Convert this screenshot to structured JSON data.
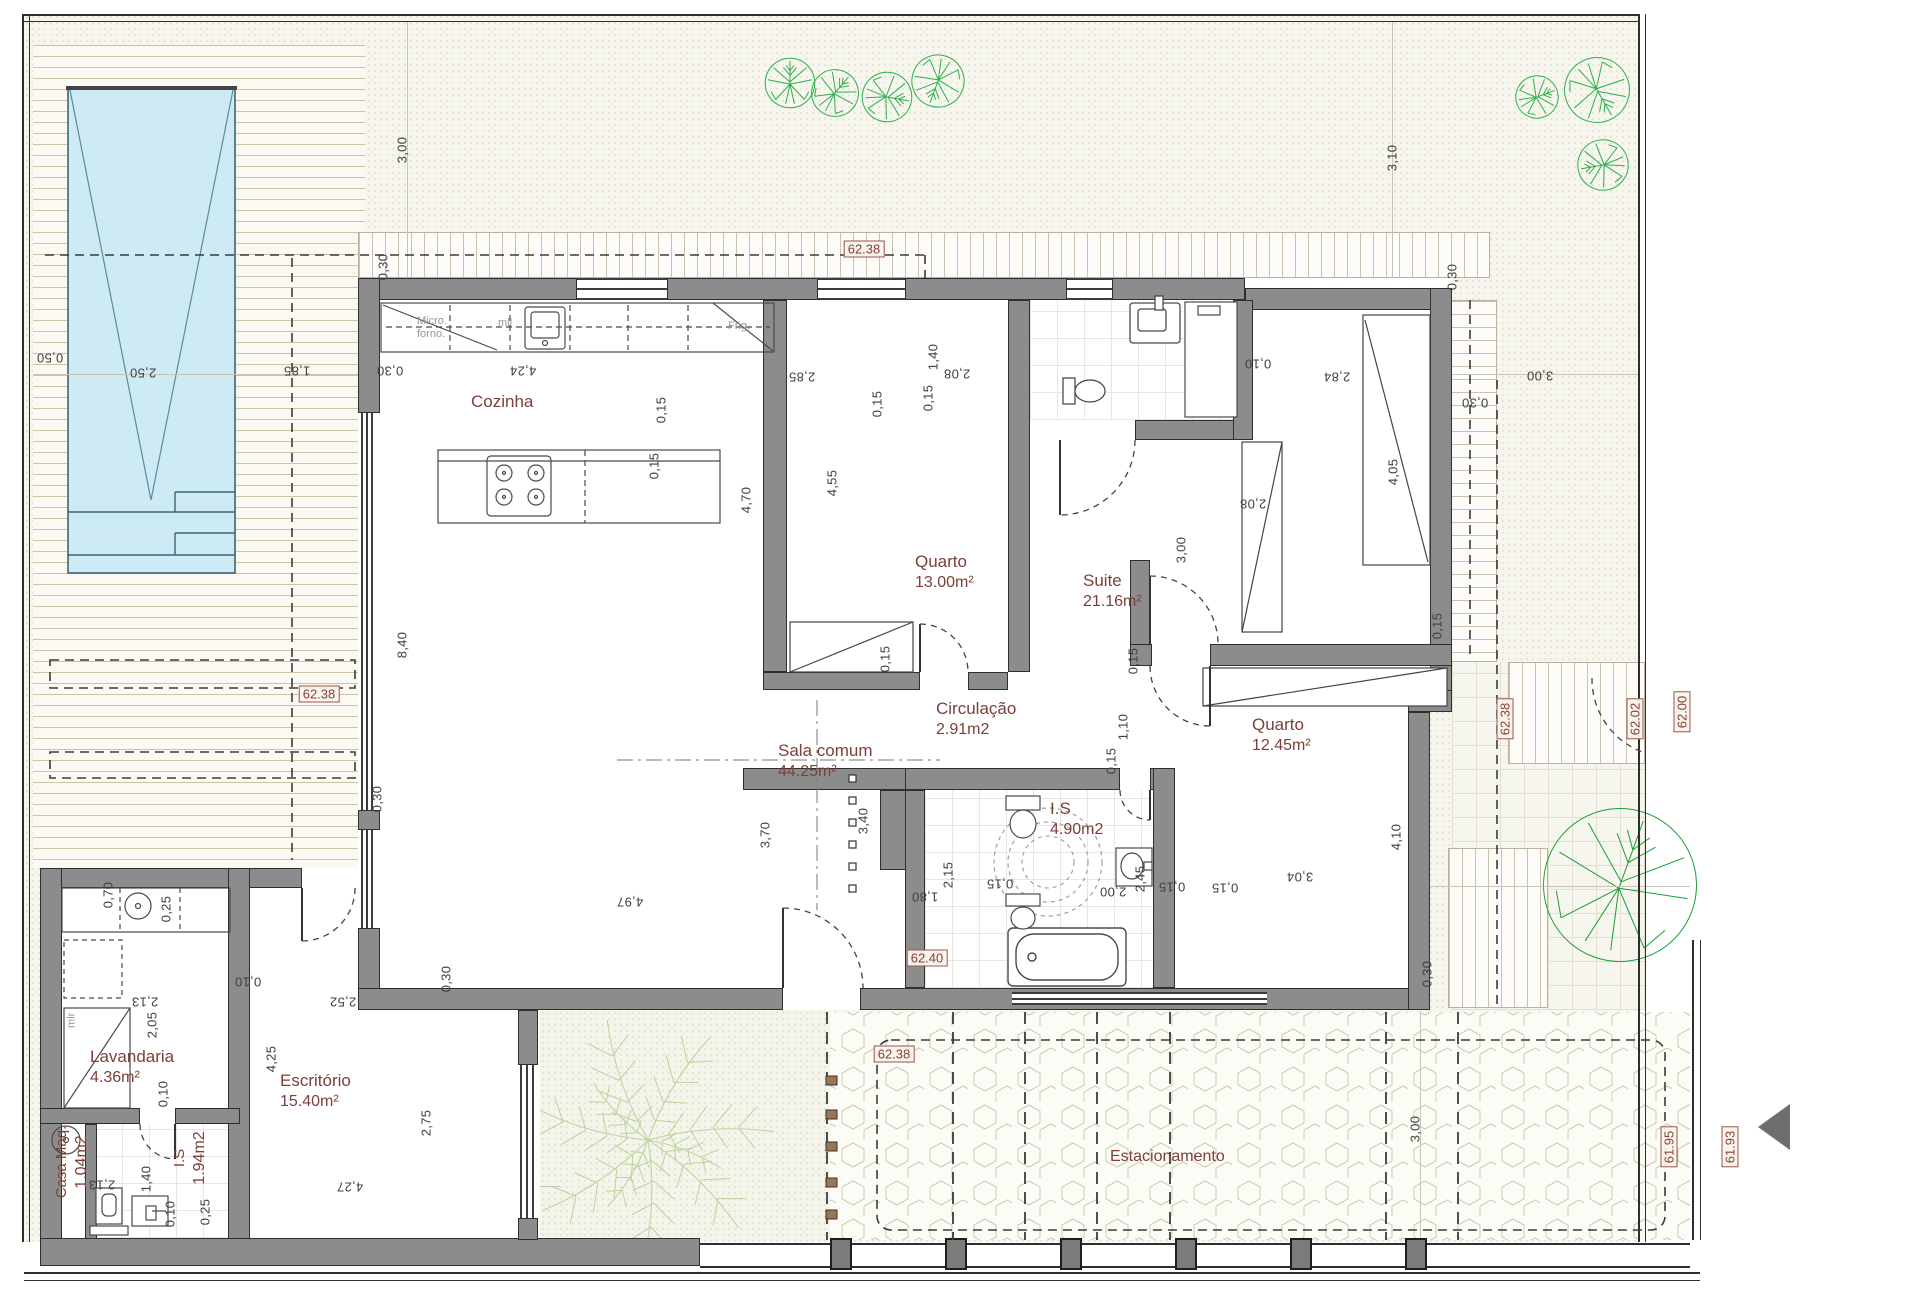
{
  "drawing_type": "architectural floor plan",
  "rooms": [
    {
      "name": "Cozinha",
      "area": ""
    },
    {
      "name": "Quarto",
      "area": "13.00m²"
    },
    {
      "name": "Suite",
      "area": "21.16m²"
    },
    {
      "name": "Circulação",
      "area": "2.91m2"
    },
    {
      "name": "Quarto",
      "area": "12.45m²"
    },
    {
      "name": "Sala comum",
      "area": "44.25m²"
    },
    {
      "name": "I.S",
      "area": "4.90m2"
    },
    {
      "name": "Lavandaria",
      "area": "4.36m²"
    },
    {
      "name": "Escritório",
      "area": "15.40m²"
    },
    {
      "name": "Casa Maq.",
      "area": "1.04m2"
    },
    {
      "name": "I.S",
      "area": "1.94m2"
    },
    {
      "name": "Estacionamento",
      "area": ""
    }
  ],
  "kitchen_labels": {
    "micro": "Micro.",
    "forno": "forno.",
    "mll": "mll",
    "frig": "Frig.",
    "mlr": "mlr"
  },
  "elevation_markers": [
    {
      "v": "62.38",
      "x": 864,
      "y": 249,
      "r": 0
    },
    {
      "v": "62.38",
      "x": 319,
      "y": 694,
      "r": 0
    },
    {
      "v": "62.40",
      "x": 927,
      "y": 958,
      "r": 0
    },
    {
      "v": "62.38",
      "x": 894,
      "y": 1054,
      "r": 0
    },
    {
      "v": "62.38",
      "x": 1505,
      "y": 719,
      "r": -90
    },
    {
      "v": "62.02",
      "x": 1635,
      "y": 719,
      "r": -90
    },
    {
      "v": "62.00",
      "x": 1682,
      "y": 712,
      "r": -90
    },
    {
      "v": "61.95",
      "x": 1669,
      "y": 1147,
      "r": -90
    },
    {
      "v": "61.93",
      "x": 1730,
      "y": 1147,
      "r": -90
    }
  ],
  "dimensions": [
    {
      "v": "3,00",
      "x": 402,
      "y": 150,
      "r": -90
    },
    {
      "v": "3,10",
      "x": 1392,
      "y": 158,
      "r": -90
    },
    {
      "v": "0,50",
      "x": 50,
      "y": 358,
      "r": 180
    },
    {
      "v": "2,50",
      "x": 143,
      "y": 373,
      "r": 180
    },
    {
      "v": "1,85",
      "x": 297,
      "y": 371,
      "r": 180
    },
    {
      "v": "0,30",
      "x": 383,
      "y": 267,
      "r": -90
    },
    {
      "v": "0,30",
      "x": 390,
      "y": 371,
      "r": 180
    },
    {
      "v": "4,24",
      "x": 523,
      "y": 371,
      "r": 180
    },
    {
      "v": "2,85",
      "x": 802,
      "y": 377,
      "r": 180
    },
    {
      "v": "0,15",
      "x": 661,
      "y": 410,
      "r": -90
    },
    {
      "v": "0,15",
      "x": 654,
      "y": 466,
      "r": -90
    },
    {
      "v": "4,70",
      "x": 746,
      "y": 500,
      "r": -90
    },
    {
      "v": "4,55",
      "x": 832,
      "y": 483,
      "r": -90
    },
    {
      "v": "1,40",
      "x": 933,
      "y": 357,
      "r": -90
    },
    {
      "v": "2,08",
      "x": 957,
      "y": 374,
      "r": 180
    },
    {
      "v": "0,15",
      "x": 928,
      "y": 398,
      "r": -90
    },
    {
      "v": "0,15",
      "x": 877,
      "y": 404,
      "r": -90
    },
    {
      "v": "0,10",
      "x": 1258,
      "y": 364,
      "r": 180
    },
    {
      "v": "2,84",
      "x": 1337,
      "y": 377,
      "r": 180
    },
    {
      "v": "3,00",
      "x": 1540,
      "y": 376,
      "r": 180
    },
    {
      "v": "0,30",
      "x": 1452,
      "y": 277,
      "r": -90
    },
    {
      "v": "0,30",
      "x": 1475,
      "y": 403,
      "r": 180
    },
    {
      "v": "4,05",
      "x": 1393,
      "y": 472,
      "r": -90
    },
    {
      "v": "2,08",
      "x": 1253,
      "y": 504,
      "r": 180
    },
    {
      "v": "3,00",
      "x": 1181,
      "y": 550,
      "r": -90
    },
    {
      "v": "0,15",
      "x": 885,
      "y": 659,
      "r": -90
    },
    {
      "v": "0,15",
      "x": 1437,
      "y": 626,
      "r": -90
    },
    {
      "v": "0,15",
      "x": 1133,
      "y": 661,
      "r": -90
    },
    {
      "v": "1,10",
      "x": 1123,
      "y": 727,
      "r": -90
    },
    {
      "v": "0,15",
      "x": 1111,
      "y": 761,
      "r": -90
    },
    {
      "v": "3,40",
      "x": 863,
      "y": 821,
      "r": -90
    },
    {
      "v": "3,70",
      "x": 765,
      "y": 835,
      "r": -90
    },
    {
      "v": "2,15",
      "x": 948,
      "y": 875,
      "r": -90
    },
    {
      "v": "1,80",
      "x": 925,
      "y": 897,
      "r": 180
    },
    {
      "v": "0,15",
      "x": 1000,
      "y": 884,
      "r": 180
    },
    {
      "v": "2,00",
      "x": 1113,
      "y": 892,
      "r": 180
    },
    {
      "v": "2,45",
      "x": 1140,
      "y": 879,
      "r": -90
    },
    {
      "v": "0,15",
      "x": 1172,
      "y": 887,
      "r": 180
    },
    {
      "v": "0,15",
      "x": 1225,
      "y": 888,
      "r": 180
    },
    {
      "v": "4,10",
      "x": 1396,
      "y": 837,
      "r": -90
    },
    {
      "v": "3,04",
      "x": 1300,
      "y": 877,
      "r": 180
    },
    {
      "v": "8,40",
      "x": 402,
      "y": 645,
      "r": -90
    },
    {
      "v": "0,70",
      "x": 108,
      "y": 895,
      "r": -90
    },
    {
      "v": "0,25",
      "x": 166,
      "y": 909,
      "r": -90
    },
    {
      "v": "2,13",
      "x": 145,
      "y": 1002,
      "r": 180
    },
    {
      "v": "2,05",
      "x": 152,
      "y": 1025,
      "r": -90
    },
    {
      "v": "0,10",
      "x": 163,
      "y": 1094,
      "r": -90
    },
    {
      "v": "0,10",
      "x": 248,
      "y": 982,
      "r": 180
    },
    {
      "v": "2,52",
      "x": 343,
      "y": 1002,
      "r": 180
    },
    {
      "v": "4,25",
      "x": 271,
      "y": 1059,
      "r": -90
    },
    {
      "v": "2,13",
      "x": 102,
      "y": 1185,
      "r": 180
    },
    {
      "v": "1,40",
      "x": 146,
      "y": 1179,
      "r": -90
    },
    {
      "v": "0,10",
      "x": 170,
      "y": 1214,
      "r": -90
    },
    {
      "v": "0,25",
      "x": 205,
      "y": 1212,
      "r": -90
    },
    {
      "v": "4,27",
      "x": 350,
      "y": 1187,
      "r": 180
    },
    {
      "v": "2,75",
      "x": 426,
      "y": 1123,
      "r": -90
    },
    {
      "v": "0,30",
      "x": 446,
      "y": 979,
      "r": -90
    },
    {
      "v": "4,97",
      "x": 630,
      "y": 902,
      "r": 180
    },
    {
      "v": "0,30",
      "x": 377,
      "y": 799,
      "r": -90
    },
    {
      "v": "3,00",
      "x": 1415,
      "y": 1129,
      "r": -90
    },
    {
      "v": "0,30",
      "x": 1427,
      "y": 974,
      "r": -90
    }
  ],
  "colors": {
    "wall_gray": "#8c8c8c",
    "room_label": "#7c4038",
    "elevation_marker": "#8a3f36",
    "pool_water": "#cdeaf5",
    "tree_green": "#2cb14a",
    "dark_tree_green": "#1a9e38",
    "palm_green": "#bcd39c",
    "hex_paving": "#c8ccb2",
    "deck_line": "#baa987"
  }
}
